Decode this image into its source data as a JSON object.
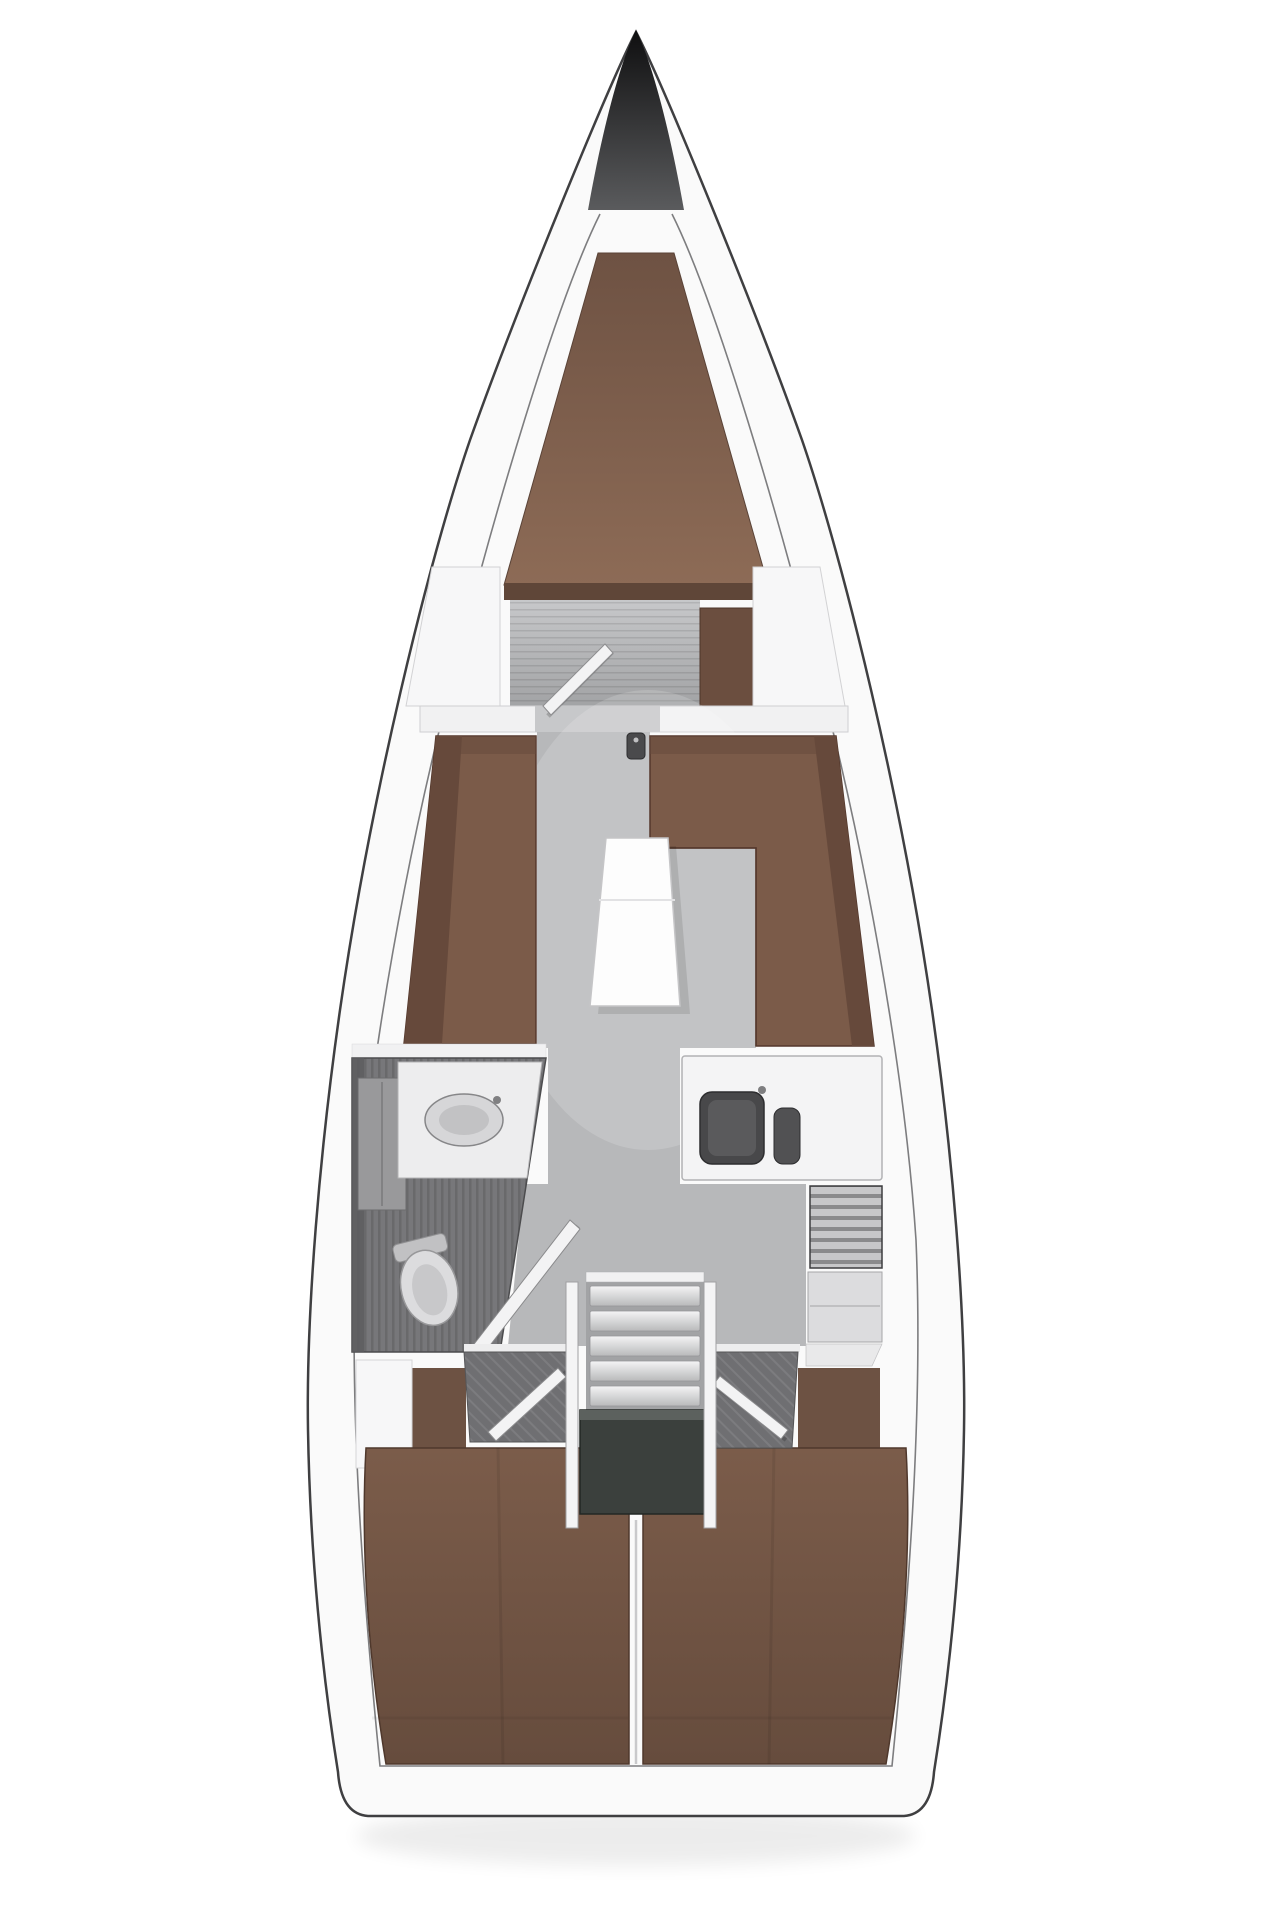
{
  "diagram": {
    "type": "floor-plan",
    "subject": "sailing-yacht-interior-top-view",
    "regions": [
      {
        "id": "bow-cone"
      },
      {
        "id": "forward-cabin"
      },
      {
        "id": "saloon"
      },
      {
        "id": "head-compartment"
      },
      {
        "id": "galley"
      },
      {
        "id": "companionway"
      },
      {
        "id": "aft-cabin-port"
      },
      {
        "id": "aft-cabin-starboard"
      }
    ]
  },
  "colors": {
    "canvas_bg": "#ffffff",
    "hull_fill": "#fafafa",
    "hull_edge": "#3f3f41",
    "hull_inner_line": "#6f6f71",
    "bow_cone_top": "#0f0f10",
    "bow_cone_bottom": "#5a5b5d",
    "berth_fwd_light": "#8d6b56",
    "berth_fwd_dark": "#6e5243",
    "berth_foot": "#5f4638",
    "floor_light": "#c7c8ca",
    "floor_mid": "#b7b8ba",
    "floor_dark": "#a2a3a5",
    "wardrobe": "#6b4e3f",
    "locker_white": "#f7f7f8",
    "bulkhead_white": "#f1f1f2",
    "door_leaf": "#f3f3f4",
    "settee_seat": "#7b5b49",
    "settee_back": "#66493b",
    "table_white": "#fdfdfd",
    "head_floor": "#77777a",
    "head_shade": "#5c5c5e",
    "counter_white": "#ededee",
    "sink_basin": "#d6d6d8",
    "sink_inner": "#c2c2c4",
    "cabinet_grey": "#99999b",
    "toilet_white": "#dcdcde",
    "toilet_inner": "#c8c8ca",
    "galley_counter": "#f4f4f5",
    "galley_sink": "#48484a",
    "galley_sink_inner": "#5a5a5c",
    "cutting_board": "#515153",
    "stove_base": "#c7c7c9",
    "stove_stripe": "#8a8a8c",
    "lower_counter": "#dcdcde",
    "step_light": "#f4f4f5",
    "step_dark": "#b9babb",
    "engine_box": "#3b403d",
    "engine_top": "#5c615e",
    "post_white": "#f4f4f5",
    "aft_floor": "#6f6f72",
    "berth_aft_light": "#7b5c4a",
    "berth_aft_dark": "#664c3d",
    "patch_brown": "#6d5243",
    "mast_dark": "#4a4a4c"
  }
}
